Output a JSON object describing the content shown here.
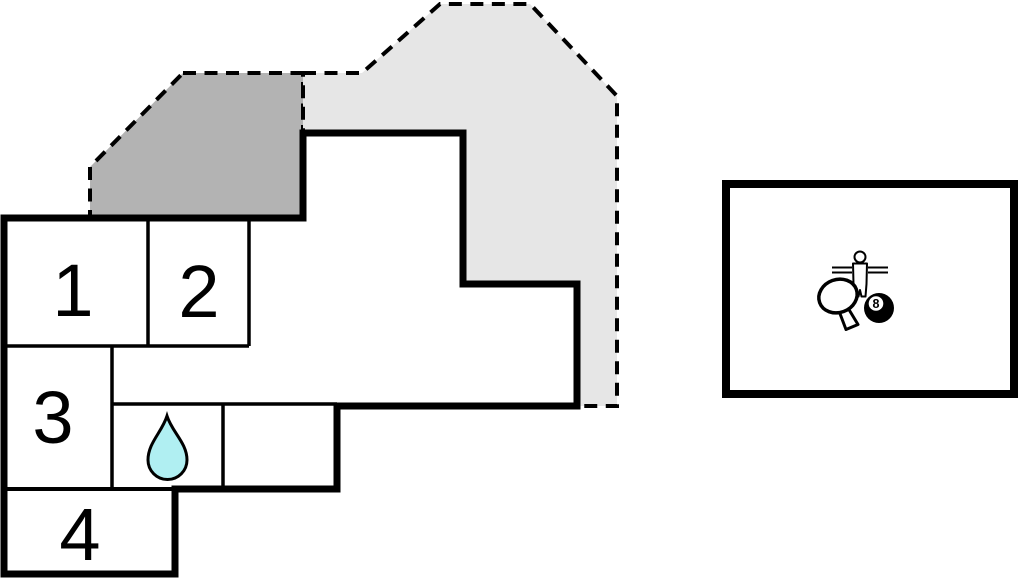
{
  "colors": {
    "wall": "#000000",
    "interior": "#ffffff",
    "terrace_dark": "#b3b3b3",
    "terrace_light": "#e6e6e6",
    "water_drop": "#b0eff2",
    "game_room_fill": "#ffffff",
    "ball_fill": "#000000"
  },
  "floor_plan": {
    "rooms": [
      {
        "number": "1"
      },
      {
        "number": "2"
      },
      {
        "number": "3"
      },
      {
        "number": "4"
      }
    ],
    "bathroom_icon": "water-drop-icon",
    "terraces": [
      {
        "id": "terrace-upper-left"
      },
      {
        "id": "terrace-upper-right"
      }
    ]
  },
  "game_room": {
    "ball_number": "8",
    "icons": [
      "foosball-player-icon",
      "table-tennis-paddle-icon",
      "billiard-8-ball-icon"
    ]
  }
}
